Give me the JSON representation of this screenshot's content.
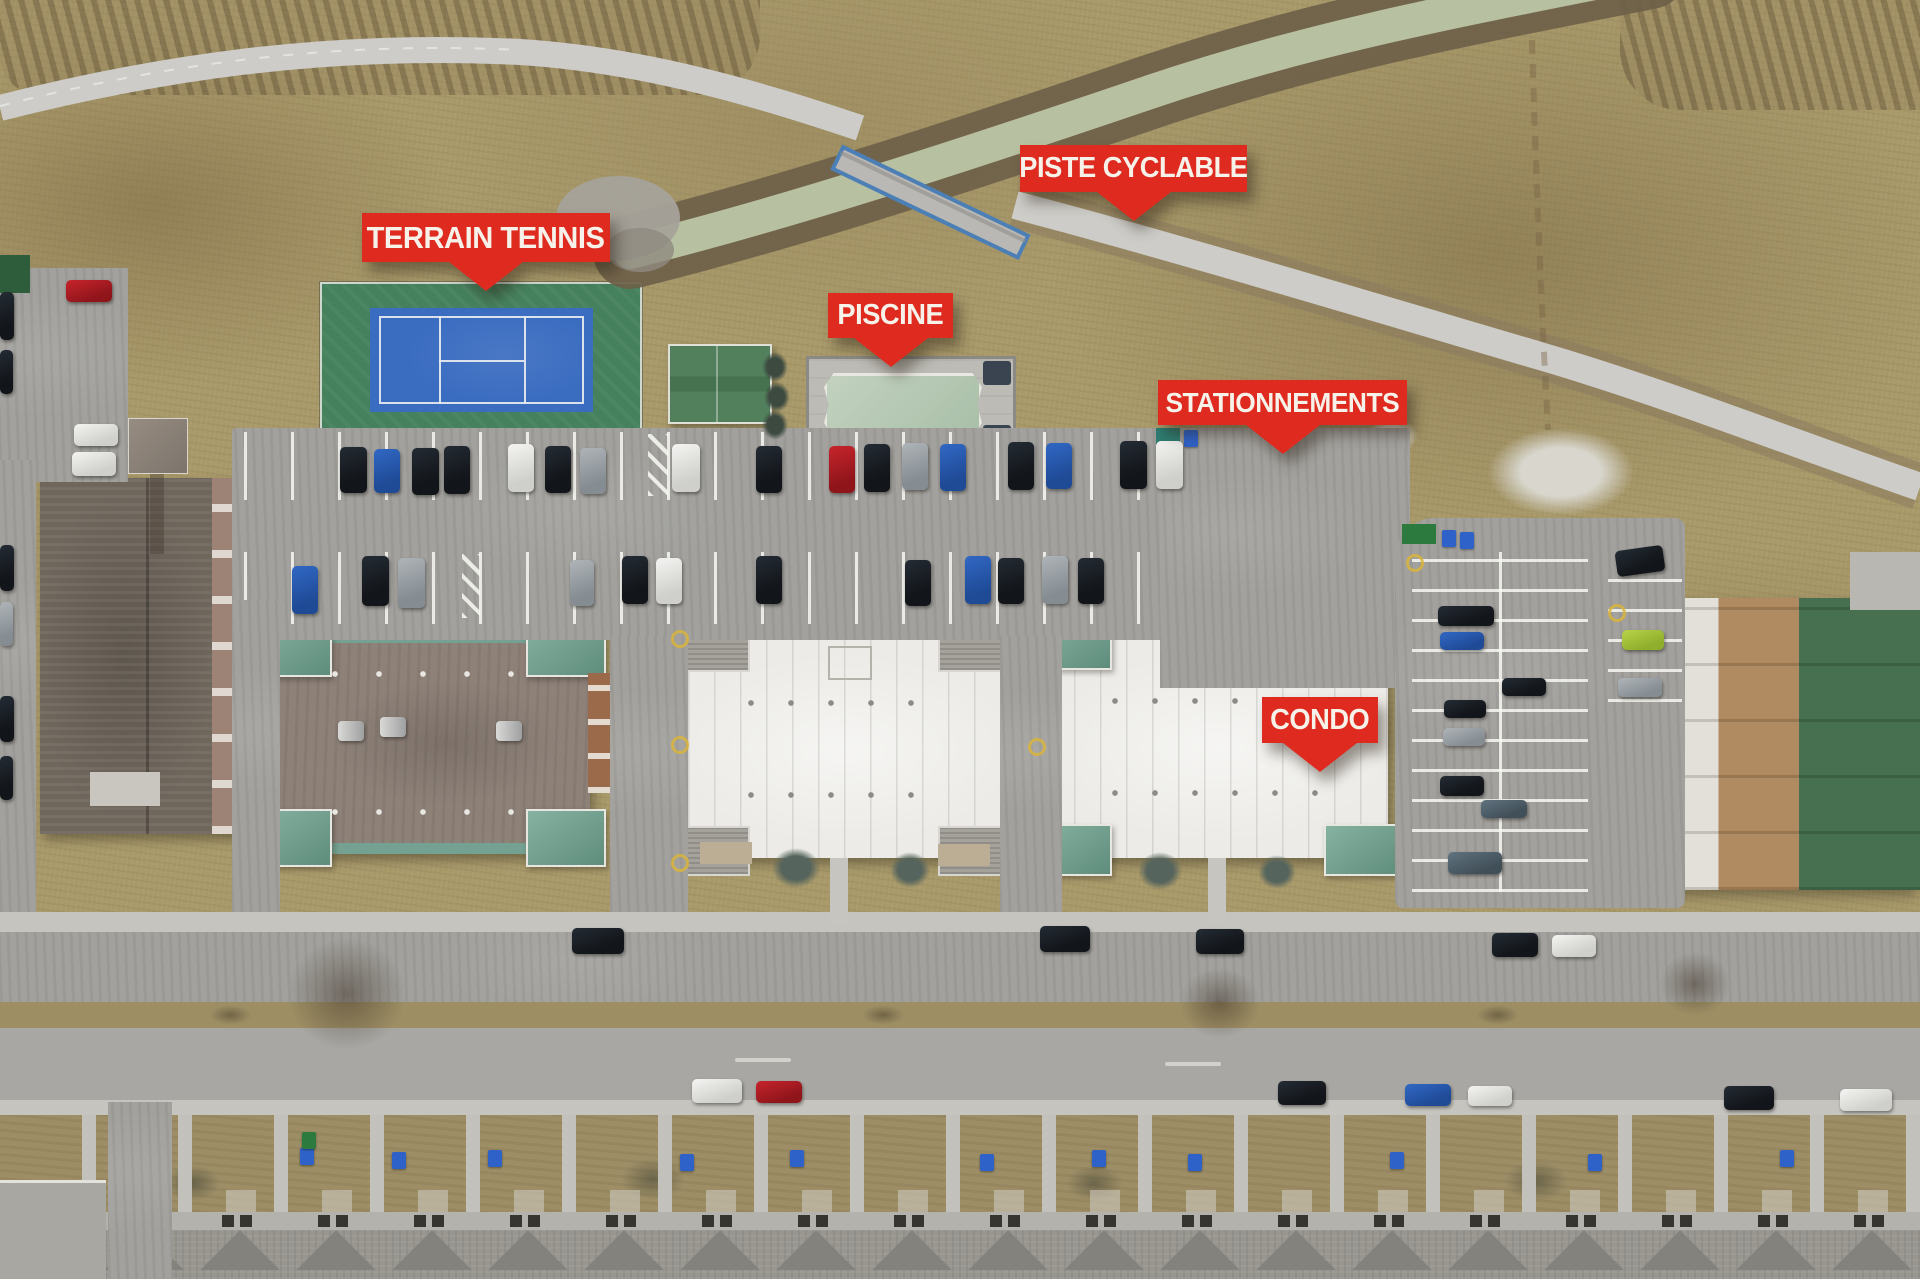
{
  "annotations": {
    "items": [
      {
        "id": "terrain-tennis",
        "text": "TERRAIN TENNIS",
        "target": "tennis-court"
      },
      {
        "id": "piste-cyclable",
        "text": "PISTE CYCLABLE",
        "target": "bike-path"
      },
      {
        "id": "piscine",
        "text": "PISCINE",
        "target": "swimming-pool"
      },
      {
        "id": "stationnements",
        "text": "STATIONNEMENTS",
        "target": "parking-lots"
      },
      {
        "id": "condo",
        "text": "CONDO",
        "target": "condo-building"
      }
    ]
  },
  "colors": {
    "label_background": "#df2b1f",
    "label_text": "#f6f1e9",
    "dry_grass": "#a89969",
    "creek_water": "#b8c0a2",
    "asphalt": "#a2a19d",
    "concrete_path": "#cdccc8",
    "tennis_surround_green": "#45815d",
    "tennis_court_blue": "#3a6cc0",
    "court_line_white": "#e8ecf0",
    "pool_water": "#b5c9b4",
    "white_roof": "#ecebe7",
    "teal_mansard": "#74a191",
    "dark_roof": "#6f665c",
    "green_roof": "#46704f"
  },
  "features": [
    "creek",
    "pedestrian-bridge",
    "bike-path",
    "tennis-court",
    "pool-house",
    "swimming-pool",
    "main-parking-lot",
    "east-parking-lot",
    "condo-building-1",
    "condo-building-2",
    "condo-building-3",
    "condo-building-4",
    "rowhouse-west",
    "boulevard",
    "townhouses-south"
  ]
}
